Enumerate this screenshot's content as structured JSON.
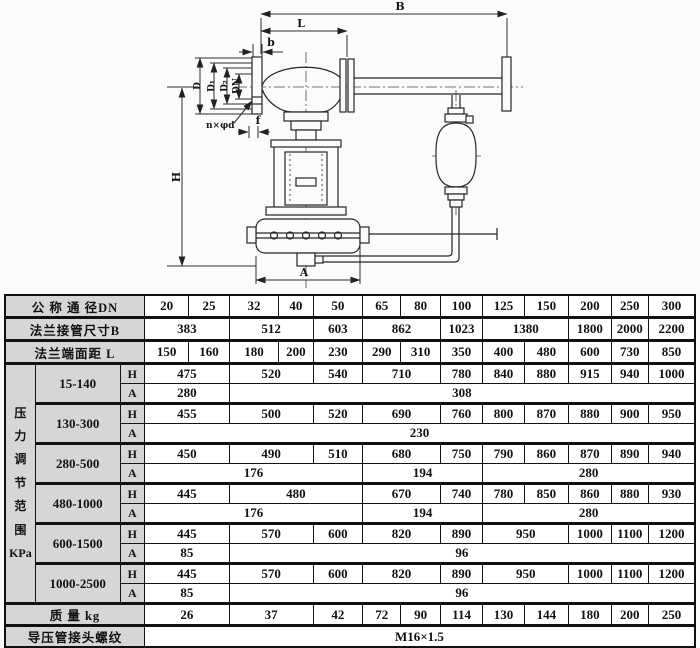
{
  "diagram": {
    "labels": {
      "B": "B",
      "L": "L",
      "b": "b",
      "f": "f",
      "H": "H",
      "A": "A",
      "bolt_spec": "n×φd",
      "D": "D",
      "D1": "D₁",
      "D2": "D₂",
      "DN": "DN"
    }
  },
  "table": {
    "rows": [
      {
        "hdr": true,
        "thick": false,
        "cells": [
          {
            "t": "公 称 通 径DN",
            "cs": 3,
            "cls": "label"
          },
          {
            "t": "20"
          },
          {
            "t": "25"
          },
          {
            "t": "32"
          },
          {
            "t": "40"
          },
          {
            "t": "50"
          },
          {
            "t": "65"
          },
          {
            "t": "80"
          },
          {
            "t": "100"
          },
          {
            "t": "125"
          },
          {
            "t": "150"
          },
          {
            "t": "200"
          },
          {
            "t": "250"
          },
          {
            "t": "300"
          }
        ]
      },
      {
        "hdr": true,
        "thick": true,
        "cells": [
          {
            "t": "法兰接管尺寸B",
            "cs": 3,
            "cls": "label"
          },
          {
            "t": "383",
            "cs": 2
          },
          {
            "t": "512",
            "cs": 2
          },
          {
            "t": "603"
          },
          {
            "t": "862",
            "cs": 2
          },
          {
            "t": "1023"
          },
          {
            "t": "1380",
            "cs": 2
          },
          {
            "t": "1800"
          },
          {
            "t": "2000"
          },
          {
            "t": "2200"
          }
        ]
      },
      {
        "hdr": true,
        "thick": true,
        "cells": [
          {
            "t": "法兰端面距  L",
            "cs": 3,
            "cls": "label"
          },
          {
            "t": "150"
          },
          {
            "t": "160"
          },
          {
            "t": "180"
          },
          {
            "t": "200"
          },
          {
            "t": "230"
          },
          {
            "t": "290"
          },
          {
            "t": "310"
          },
          {
            "t": "350"
          },
          {
            "t": "400"
          },
          {
            "t": "480"
          },
          {
            "t": "600"
          },
          {
            "t": "730"
          },
          {
            "t": "850"
          }
        ]
      },
      {
        "thick": true,
        "cells": [
          {
            "t": "压 力 调 节 范 围 KPa",
            "rs": 12,
            "cls": "vlabel"
          },
          {
            "t": "15-140",
            "rs": 2,
            "cls": "range"
          },
          {
            "t": "H",
            "cls": "sub"
          },
          {
            "t": "475",
            "cs": 2
          },
          {
            "t": "520",
            "cs": 2
          },
          {
            "t": "540"
          },
          {
            "t": "710",
            "cs": 2
          },
          {
            "t": "780"
          },
          {
            "t": "840"
          },
          {
            "t": "880"
          },
          {
            "t": "915"
          },
          {
            "t": "940"
          },
          {
            "t": "1000"
          }
        ]
      },
      {
        "cells": [
          {
            "t": "A",
            "cls": "sub"
          },
          {
            "t": "280",
            "cs": 2
          },
          {
            "t": "308",
            "cs": 11
          }
        ]
      },
      {
        "thick": true,
        "cells": [
          {
            "t": "130-300",
            "rs": 2,
            "cls": "range"
          },
          {
            "t": "H",
            "cls": "sub"
          },
          {
            "t": "455",
            "cs": 2
          },
          {
            "t": "500",
            "cs": 2
          },
          {
            "t": "520"
          },
          {
            "t": "690",
            "cs": 2
          },
          {
            "t": "760"
          },
          {
            "t": "800"
          },
          {
            "t": "870"
          },
          {
            "t": "880"
          },
          {
            "t": "900"
          },
          {
            "t": "950"
          }
        ]
      },
      {
        "cells": [
          {
            "t": "A",
            "cls": "sub"
          },
          {
            "t": "230",
            "cs": 13
          }
        ]
      },
      {
        "thick": true,
        "cells": [
          {
            "t": "280-500",
            "rs": 2,
            "cls": "range"
          },
          {
            "t": "H",
            "cls": "sub"
          },
          {
            "t": "450",
            "cs": 2
          },
          {
            "t": "490",
            "cs": 2
          },
          {
            "t": "510"
          },
          {
            "t": "680",
            "cs": 2
          },
          {
            "t": "750"
          },
          {
            "t": "790"
          },
          {
            "t": "860"
          },
          {
            "t": "870"
          },
          {
            "t": "890"
          },
          {
            "t": "940"
          }
        ]
      },
      {
        "cells": [
          {
            "t": "A",
            "cls": "sub"
          },
          {
            "t": "176",
            "cs": 5
          },
          {
            "t": "194",
            "cs": 3
          },
          {
            "t": "280",
            "cs": 5
          }
        ]
      },
      {
        "thick": true,
        "cells": [
          {
            "t": "480-1000",
            "rs": 2,
            "cls": "range"
          },
          {
            "t": "H",
            "cls": "sub"
          },
          {
            "t": "445",
            "cs": 2
          },
          {
            "t": "480",
            "cs": 3
          },
          {
            "t": "670",
            "cs": 2
          },
          {
            "t": "740"
          },
          {
            "t": "780"
          },
          {
            "t": "850"
          },
          {
            "t": "860"
          },
          {
            "t": "880"
          },
          {
            "t": "930"
          }
        ]
      },
      {
        "cells": [
          {
            "t": "A",
            "cls": "sub"
          },
          {
            "t": "176",
            "cs": 5
          },
          {
            "t": "194",
            "cs": 3
          },
          {
            "t": "280",
            "cs": 5
          }
        ]
      },
      {
        "thick": true,
        "cells": [
          {
            "t": "600-1500",
            "rs": 2,
            "cls": "range"
          },
          {
            "t": "H",
            "cls": "sub"
          },
          {
            "t": "445",
            "cs": 2
          },
          {
            "t": "570",
            "cs": 2
          },
          {
            "t": "600"
          },
          {
            "t": "820",
            "cs": 2
          },
          {
            "t": "890"
          },
          {
            "t": "950",
            "cs": 2
          },
          {
            "t": "1000"
          },
          {
            "t": "1100"
          },
          {
            "t": "1200"
          }
        ]
      },
      {
        "cells": [
          {
            "t": "A",
            "cls": "sub"
          },
          {
            "t": "85",
            "cs": 2
          },
          {
            "t": "96",
            "cs": 11
          }
        ]
      },
      {
        "thick": true,
        "cells": [
          {
            "t": "1000-2500",
            "rs": 2,
            "cls": "range"
          },
          {
            "t": "H",
            "cls": "sub"
          },
          {
            "t": "445",
            "cs": 2
          },
          {
            "t": "570",
            "cs": 2
          },
          {
            "t": "600"
          },
          {
            "t": "820",
            "cs": 2
          },
          {
            "t": "890"
          },
          {
            "t": "950",
            "cs": 2
          },
          {
            "t": "1000"
          },
          {
            "t": "1100"
          },
          {
            "t": "1200"
          }
        ]
      },
      {
        "cells": [
          {
            "t": "A",
            "cls": "sub"
          },
          {
            "t": "85",
            "cs": 2
          },
          {
            "t": "96",
            "cs": 11
          }
        ]
      },
      {
        "thick": true,
        "cells": [
          {
            "t": "质   量  kg",
            "cs": 3,
            "cls": "label"
          },
          {
            "t": "26",
            "cs": 2
          },
          {
            "t": "37",
            "cs": 2
          },
          {
            "t": "42"
          },
          {
            "t": "72"
          },
          {
            "t": "90"
          },
          {
            "t": "114"
          },
          {
            "t": "130"
          },
          {
            "t": "144"
          },
          {
            "t": "180"
          },
          {
            "t": "200"
          },
          {
            "t": "250"
          }
        ]
      },
      {
        "thick": true,
        "cells": [
          {
            "t": "导压管接头螺纹",
            "cs": 3,
            "cls": "label"
          },
          {
            "t": "M16×1.5",
            "cs": 13
          }
        ]
      }
    ]
  }
}
